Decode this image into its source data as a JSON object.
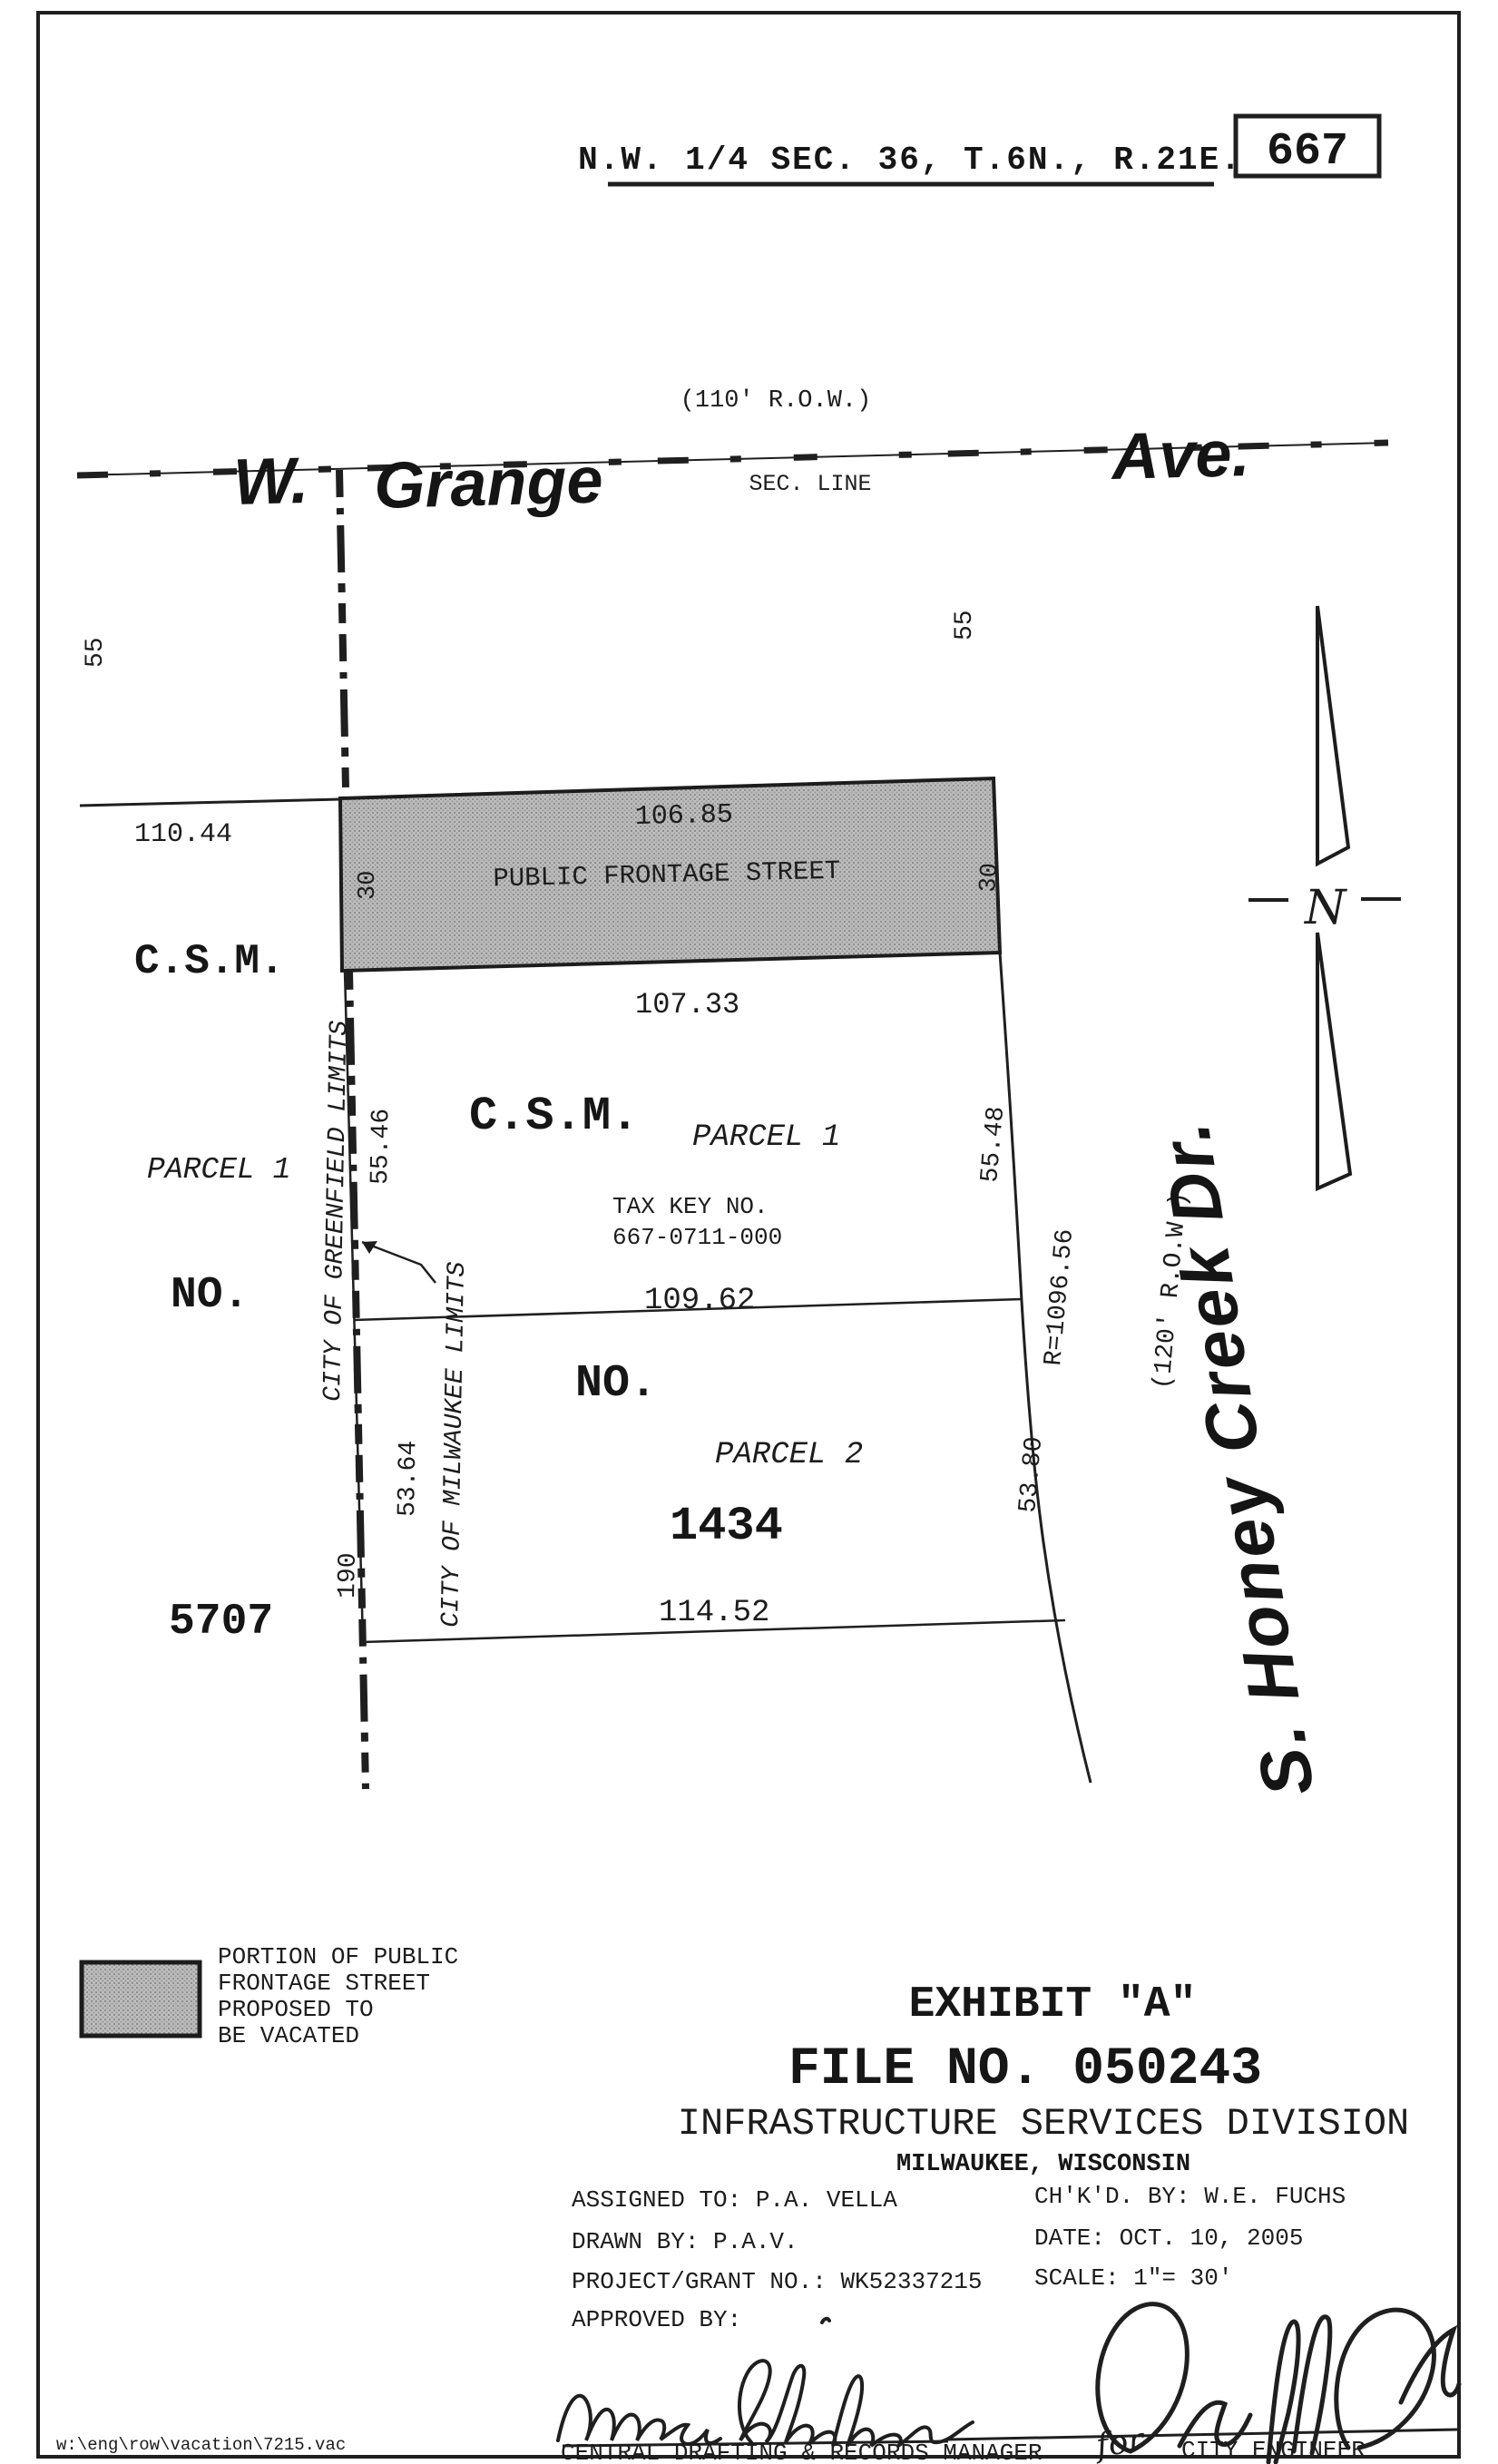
{
  "page": {
    "sheet_number": "667",
    "section_title": "N.W. 1/4 SEC. 36, T.6N., R.21E.",
    "file_path_note": "w:\\eng\\row\\vacation\\7215.vac"
  },
  "colors": {
    "ink": "#1c1c1c",
    "shade_fill": "#b5b5b5",
    "paper": "#ffffff"
  },
  "streets": {
    "grange_prefix": "W.",
    "grange_name": "Grange",
    "grange_suffix": "Ave.",
    "grange_row_note": "(110' R.O.W.)",
    "section_line_label": "SEC. LINE",
    "honey_creek_name": "S. Honey Creek Dr.",
    "honey_creek_row_note": "(120' R.O.W.)"
  },
  "north_arrow": {
    "label": "N"
  },
  "frontage_band": {
    "label": "PUBLIC FRONTAGE STREET",
    "top_dim": "106.85",
    "bottom_dim": "107.33",
    "width_left": "30",
    "width_right": "30"
  },
  "dimensions": {
    "d_55_left": "55",
    "d_55_mid": "55",
    "d_110_44": "110.44",
    "d_55_46": "55.46",
    "d_53_64": "53.64",
    "d_190": "190",
    "d_55_48": "55.48",
    "radius": "R=1096.56",
    "d_53_80": "53.80",
    "d_109_62": "109.62",
    "d_114_52": "114.52"
  },
  "csm_left": {
    "line1": "C.S.M.",
    "line2": "PARCEL 1",
    "line3": "NO.",
    "line4": "5707"
  },
  "csm_center": {
    "title": "C.S.M.",
    "parcel1": "PARCEL 1",
    "tax_key_label": "TAX KEY NO.",
    "tax_key": "667-0711-000",
    "no_label": "NO.",
    "parcel2": "PARCEL 2",
    "number": "1434"
  },
  "limits": {
    "greenfield": "CITY OF GREENFIELD LIMITS",
    "milwaukee": "CITY OF MILWAUKEE LIMITS"
  },
  "legend": {
    "lines": [
      "PORTION OF PUBLIC",
      "FRONTAGE STREET",
      "PROPOSED TO",
      "BE VACATED"
    ]
  },
  "title_block": {
    "exhibit": "EXHIBIT \"A\"",
    "file_no": "FILE NO. 050243",
    "division": "INFRASTRUCTURE SERVICES DIVISION",
    "city": "MILWAUKEE, WISCONSIN",
    "assigned_to": "ASSIGNED TO: P.A. VELLA",
    "checked_by": "CH'K'D. BY: W.E. FUCHS",
    "drawn_by": "DRAWN BY:  P.A.V.",
    "date": "DATE:  OCT. 10, 2005",
    "project": "PROJECT/GRANT NO.: WK52337215",
    "scale": "SCALE:  1\"= 30'",
    "approved_by": "APPROVED BY:",
    "left_signature_title": "CENTRAL DRAFTING & RECORDS MANAGER",
    "right_signature_note": "for",
    "right_signature_title": "CITY ENGINEER"
  }
}
